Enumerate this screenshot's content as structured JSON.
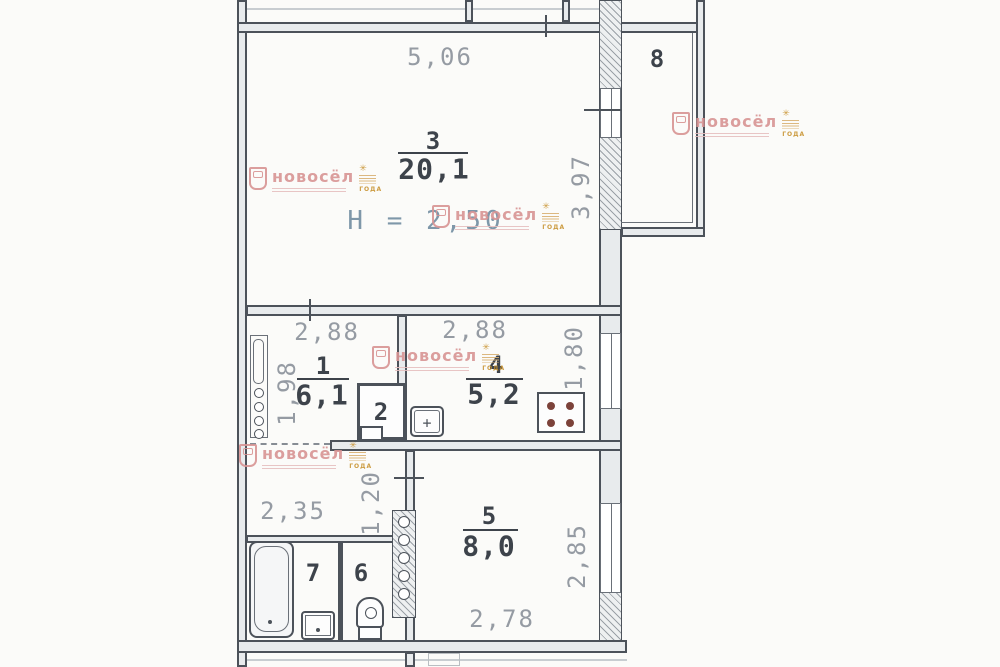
{
  "plan": {
    "type": "apartment-floor-plan-scan",
    "rooms": {
      "r1": {
        "num": "1",
        "area": "6,1"
      },
      "r2": {
        "num": "2"
      },
      "r3": {
        "num": "3",
        "area": "20,1",
        "height": "H = 2,50"
      },
      "r4": {
        "num": "4",
        "area": "5,2"
      },
      "r5": {
        "num": "5",
        "area": "8,0"
      },
      "r6": {
        "num": "6"
      },
      "r7": {
        "num": "7"
      },
      "r8": {
        "num": "8"
      }
    },
    "dims": {
      "room3_top": "5,06",
      "room3_right": "3,97",
      "room1_top": "2,88",
      "room1_left": "1,98",
      "kitchen_top": "2,88",
      "kitchen_right": "1,80",
      "corridor_width": "2,35",
      "hall_width": "1,20",
      "room5_bottom": "2,78",
      "room5_right": "2,85"
    },
    "colors": {
      "wall_line": "#4c525a",
      "dim_text": "#959ba3",
      "label_text": "#3d434b",
      "height_note": "#7e97a9"
    }
  },
  "watermark": {
    "brand": "новосёл",
    "badge": "ГОДА",
    "brand_color": "#d89494",
    "badge_color": "#c8922f"
  }
}
